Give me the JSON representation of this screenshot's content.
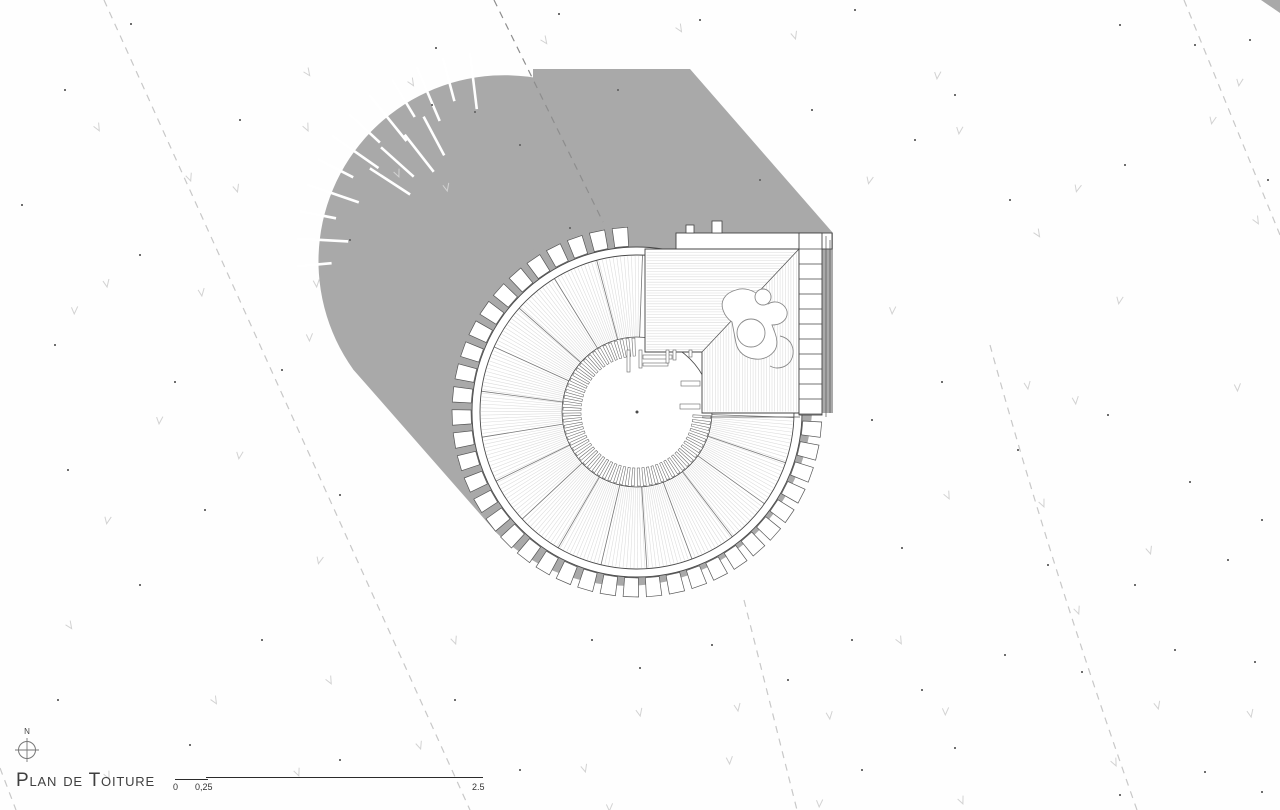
{
  "meta": {
    "title": "Plan de Toiture"
  },
  "north": {
    "label": "N"
  },
  "scalebar": {
    "labels": [
      "0",
      "0,25",
      "2.5"
    ]
  },
  "colors": {
    "shadow": "#a9a9a9",
    "dash_light": "#c8c8c8",
    "dash_dark": "#8d8d8d",
    "grain": "#dbdbdb",
    "line_dark": "#4a4a4a",
    "line_mid": "#666666",
    "wedge": "#787878",
    "grass": "#d2d2d2",
    "dot": "#6e6e6e",
    "text": "#3a3a3a"
  },
  "plan": {
    "ring": {
      "center": [
        637,
        412
      ],
      "tick_r": [
        56,
        74
      ],
      "ann_r": [
        75,
        157
      ],
      "fascia_r": [
        157,
        165
      ],
      "teeth_r": [
        166,
        185
      ],
      "span": [
        2,
        272
      ],
      "wedge_n": 16,
      "hair_step": 1.35,
      "tick_step": 4.7,
      "tick_halfw": 1.15,
      "teeth_step": 7.2,
      "teeth_halfw": 2.4
    },
    "square": {
      "outline": "645,249 799,249 799,413 702,413 702,352 645,352",
      "diag": [
        799,
        249,
        702,
        352
      ],
      "band": [
        676,
        233,
        156,
        16
      ],
      "bumps": [
        [
          686,
          225,
          8,
          8
        ],
        [
          712,
          221,
          10,
          12
        ]
      ],
      "ladder": [
        799,
        233,
        23,
        182
      ],
      "rung_x2": 822,
      "rung_y0": 249,
      "rung_dy": 15,
      "rung_n": 11,
      "extra_v": [
        [
          826,
          236,
          417
        ],
        [
          830,
          240,
          413
        ]
      ],
      "bottom_fascia": [
        702,
        417,
        800,
        417
      ]
    },
    "shadow": {
      "capsule": "M634.6,128.3 A186,186 0 0 0 353.4,369.7 L496.4,532.7 A186,186 0 0 0 777.6,291.3 Z",
      "hull": "M533,69 L690,69 L833,233 L833,413 L676,413 L533,249 Z",
      "corner_triangle": "1261,0 1280,0 1280,13",
      "slit_center": [
        494,
        249
      ],
      "slits": [
        [
          175,
          163,
          198
        ],
        [
          183,
          146,
          198
        ],
        [
          191,
          161,
          198
        ],
        [
          199,
          143,
          198
        ],
        [
          207,
          158,
          198
        ],
        [
          215,
          141,
          198
        ],
        [
          223,
          156,
          198
        ],
        [
          231,
          139,
          198
        ],
        [
          239,
          154,
          198
        ],
        [
          247,
          139,
          198
        ],
        [
          255,
          153,
          198
        ],
        [
          263,
          141,
          198
        ],
        [
          213,
          100,
          148
        ],
        [
          222,
          108,
          152
        ],
        [
          232,
          98,
          145
        ],
        [
          242,
          106,
          150
        ]
      ]
    },
    "dashes": {
      "light": [
        "M104,0 L470,810",
        "M744,600 L797,810",
        "M990,345 Q1052,570 1137,810",
        "M1184,0 L1280,235",
        "M0,768 L16,810"
      ],
      "dark": [
        "M494,0 L603,222"
      ]
    },
    "sticks": {
      "h": [
        [
          643,
          355,
          29,
          4
        ],
        [
          643,
          363,
          25,
          3
        ],
        [
          681,
          381,
          19,
          5
        ],
        [
          680,
          404,
          20,
          5
        ]
      ],
      "v": [
        [
          627,
          350,
          3,
          22
        ],
        [
          639,
          350,
          3,
          18
        ],
        [
          666,
          350,
          3,
          13
        ],
        [
          673,
          350,
          3,
          10
        ],
        [
          689,
          350,
          3,
          7
        ]
      ]
    },
    "person": {
      "body": "M736,290 c-11,3 -16,11 -13,20 c2,6 6,10 9,12 l4,21 c2,10 10,15 19,16 c9,1 16,-3 20,-9 c3,-5 2,-12 0,-17 l-3,-8 c6,0 11,-2 14,-7 c3,-6 0,-12 -6,-15 c-4,-2 -9,-1 -12,1 l-8,-8 c-7,-6 -16,-9 -24,-6 z",
      "head": [
        751,
        333,
        14
      ],
      "top_lobe": [
        763,
        297,
        8
      ],
      "arm": "M780,336 c9,2 14,9 13,18 c-1,9 -8,14 -16,14 c-3,0 -5,-1 -7,-2"
    }
  },
  "scatter": {
    "grass": [
      [
        308,
        72
      ],
      [
        412,
        82
      ],
      [
        98,
        127
      ],
      [
        307,
        127
      ],
      [
        398,
        173
      ],
      [
        190,
        177
      ],
      [
        237,
        188
      ],
      [
        447,
        187
      ],
      [
        107,
        283
      ],
      [
        202,
        292
      ],
      [
        317,
        283
      ],
      [
        310,
        337
      ],
      [
        75,
        310
      ],
      [
        160,
        420
      ],
      [
        240,
        455
      ],
      [
        108,
        520
      ],
      [
        320,
        560
      ],
      [
        70,
        625
      ],
      [
        215,
        700
      ],
      [
        330,
        680
      ],
      [
        108,
        775
      ],
      [
        298,
        772
      ],
      [
        420,
        745
      ],
      [
        585,
        768
      ],
      [
        640,
        712
      ],
      [
        738,
        707
      ],
      [
        830,
        715
      ],
      [
        730,
        760
      ],
      [
        610,
        807
      ],
      [
        820,
        803
      ],
      [
        938,
        75
      ],
      [
        1240,
        82
      ],
      [
        1213,
        120
      ],
      [
        1078,
        188
      ],
      [
        1038,
        233
      ],
      [
        1257,
        220
      ],
      [
        948,
        495
      ],
      [
        1043,
        503
      ],
      [
        1078,
        610
      ],
      [
        1150,
        550
      ],
      [
        1158,
        705
      ],
      [
        1251,
        713
      ],
      [
        1028,
        385
      ],
      [
        1076,
        400
      ],
      [
        1238,
        387
      ],
      [
        946,
        711
      ],
      [
        893,
        310
      ],
      [
        960,
        130
      ],
      [
        1120,
        300
      ],
      [
        870,
        180
      ],
      [
        545,
        40
      ],
      [
        680,
        28
      ],
      [
        900,
        640
      ],
      [
        1115,
        762
      ],
      [
        962,
        800
      ],
      [
        455,
        640
      ],
      [
        795,
        35
      ]
    ],
    "dots": [
      [
        131,
        24
      ],
      [
        436,
        48
      ],
      [
        559,
        14
      ],
      [
        855,
        10
      ],
      [
        1120,
        25
      ],
      [
        1250,
        40
      ],
      [
        65,
        90
      ],
      [
        240,
        120
      ],
      [
        520,
        145
      ],
      [
        955,
        95
      ],
      [
        1195,
        45
      ],
      [
        22,
        205
      ],
      [
        140,
        255
      ],
      [
        350,
        240
      ],
      [
        915,
        140
      ],
      [
        1010,
        200
      ],
      [
        1125,
        165
      ],
      [
        1268,
        180
      ],
      [
        55,
        345
      ],
      [
        175,
        382
      ],
      [
        282,
        370
      ],
      [
        68,
        470
      ],
      [
        205,
        510
      ],
      [
        340,
        495
      ],
      [
        140,
        585
      ],
      [
        262,
        640
      ],
      [
        58,
        700
      ],
      [
        190,
        745
      ],
      [
        340,
        760
      ],
      [
        455,
        700
      ],
      [
        520,
        770
      ],
      [
        640,
        668
      ],
      [
        712,
        645
      ],
      [
        788,
        680
      ],
      [
        852,
        640
      ],
      [
        922,
        690
      ],
      [
        1005,
        655
      ],
      [
        1082,
        672
      ],
      [
        1175,
        650
      ],
      [
        1255,
        662
      ],
      [
        872,
        420
      ],
      [
        942,
        382
      ],
      [
        1018,
        450
      ],
      [
        1108,
        415
      ],
      [
        1190,
        482
      ],
      [
        1262,
        520
      ],
      [
        902,
        548
      ],
      [
        1048,
        565
      ],
      [
        1135,
        585
      ],
      [
        1228,
        560
      ],
      [
        862,
        770
      ],
      [
        955,
        748
      ],
      [
        1120,
        795
      ],
      [
        1205,
        772
      ],
      [
        1262,
        792
      ],
      [
        592,
        640
      ],
      [
        432,
        105
      ],
      [
        700,
        20
      ],
      [
        475,
        112
      ],
      [
        570,
        228
      ],
      [
        618,
        90
      ],
      [
        760,
        180
      ],
      [
        812,
        110
      ]
    ]
  }
}
